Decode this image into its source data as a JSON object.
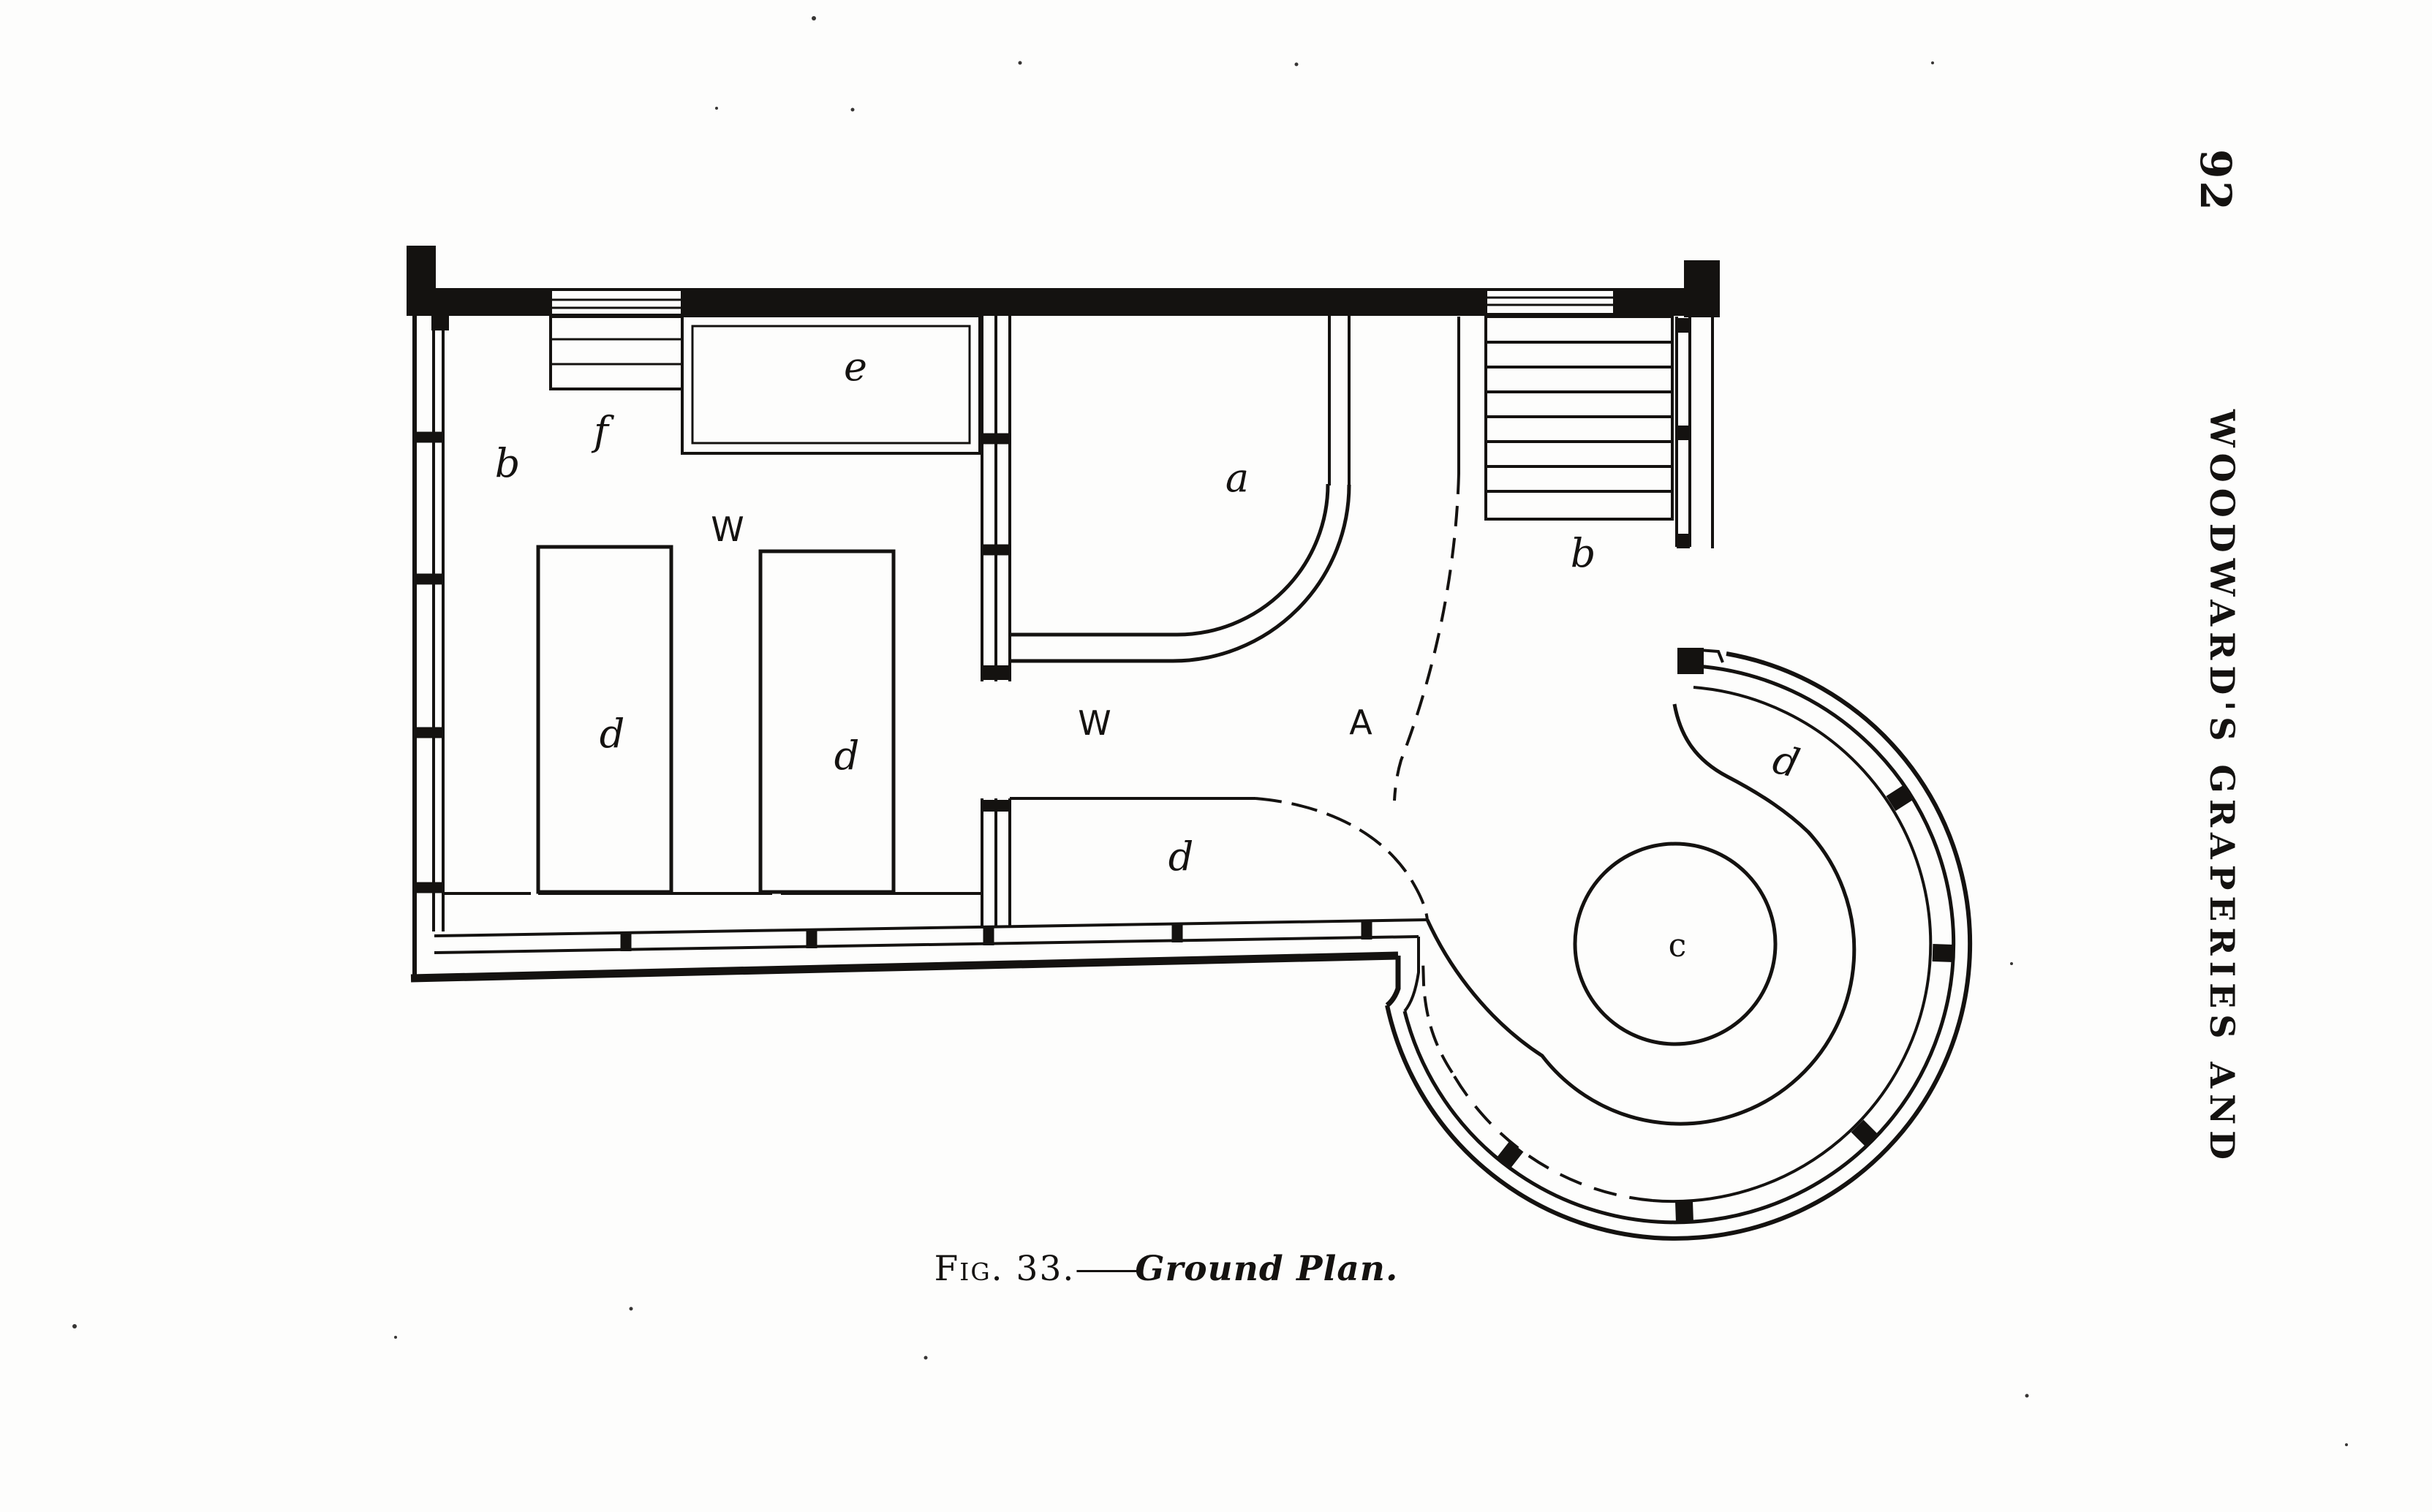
{
  "page": {
    "number": "92",
    "running_head": "WOODWARD'S GRAPERIES AND"
  },
  "figure": {
    "caption": {
      "prefix": "Fig. 33.",
      "separator": "——",
      "title": "Ground Plan."
    },
    "labels": {
      "room_b": "b",
      "steps_f": "f",
      "shed_e": "e",
      "walk_upper": "W",
      "grapery_a": "a",
      "stairs_b": "b",
      "pier_left_d": "d",
      "pier_right_d": "d",
      "walk_lower": "W",
      "area_a": "A",
      "passage_d": "d",
      "ring_walk_d": "d",
      "round_house_c": "c"
    }
  }
}
